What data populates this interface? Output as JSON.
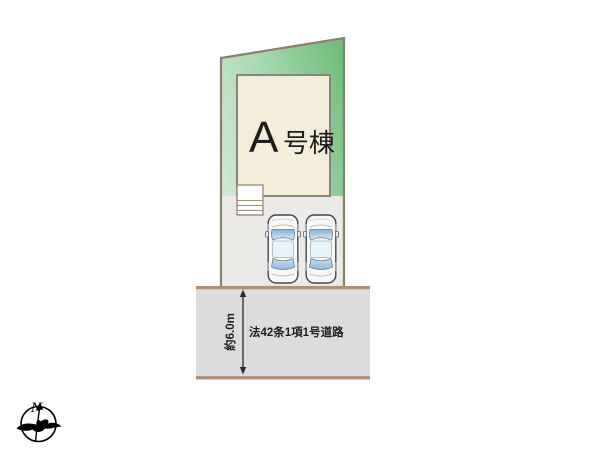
{
  "diagram": {
    "building": {
      "name_letter": "A",
      "name_suffix": "号棟"
    },
    "road": {
      "name": "法42条1項1号道路",
      "width_label": "約6.0m"
    },
    "compass": {
      "north": "N"
    },
    "parking": {
      "car_count": 2
    },
    "colors": {
      "lot_green_light": "#cfe9d4",
      "lot_green_dark": "#6fbe7d",
      "lot_border": "#8d7f6d",
      "building_fill": "#f3edda",
      "building_border": "#87867c",
      "parking_fill": "#eceae6",
      "road_fill": "#dcdcdc",
      "road_border": "#b08d76",
      "car_glass_blue": "#82b0d8",
      "steps_fill": "#ffffff"
    }
  }
}
